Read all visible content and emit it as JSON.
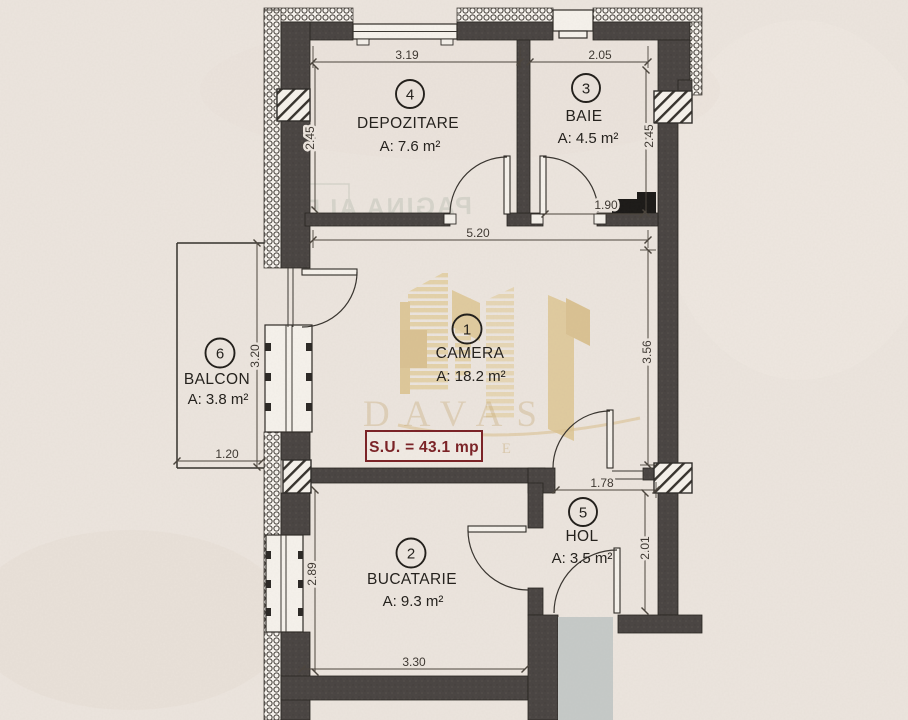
{
  "rooms": {
    "camera": {
      "number": "1",
      "name": "CAMERA",
      "area": "A: 18.2 m²"
    },
    "bucatarie": {
      "number": "2",
      "name": "BUCATARIE",
      "area": "A: 9.3 m²"
    },
    "baie": {
      "number": "3",
      "name": "BAIE",
      "area": "A: 4.5 m²"
    },
    "depozitare": {
      "number": "4",
      "name": "DEPOZITARE",
      "area": "A: 7.6 m²"
    },
    "hol": {
      "number": "5",
      "name": "HOL",
      "area": "A: 3.5 m²"
    },
    "balcon": {
      "number": "6",
      "name": "BALCON",
      "area": "A: 3.8 m²"
    }
  },
  "total_area": {
    "label": "S.U. = 43.1 mp"
  },
  "dimensions": {
    "depozitare_width": "3.19",
    "baie_width": "2.05",
    "depozitare_height": "2.45",
    "baie_height": "2.45",
    "baie_niche": "1.90",
    "camera_width": "5.20",
    "camera_height": "3.56",
    "balcon_height": "3.20",
    "balcon_width": "1.20",
    "hol_width": "1.78",
    "hol_height": "2.01",
    "bucatarie_height": "2.89",
    "bucatarie_width": "3.30"
  },
  "watermark": {
    "brand": "DAVAS",
    "partial_letters": "R E"
  },
  "bleedthrough": {
    "text": "PAGINA ALBA"
  },
  "colors": {
    "wall": "#494442",
    "paper": "#ece5de",
    "accent_red": "#7b2125",
    "watermark_gold": "#dcc493",
    "entrance_mat": "#c6cac8"
  }
}
